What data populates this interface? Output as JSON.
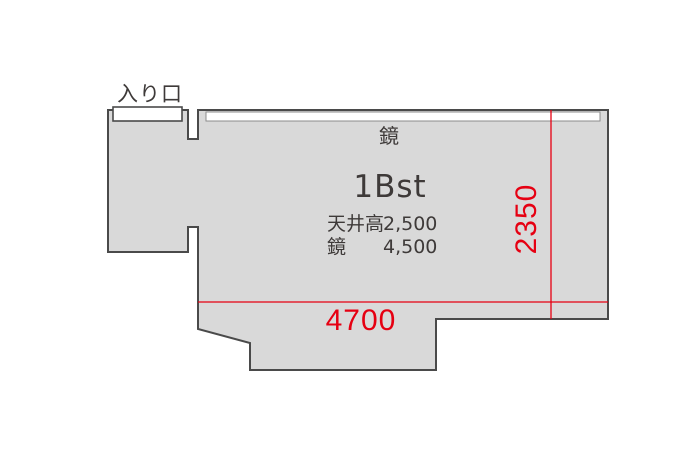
{
  "plan": {
    "entrance_label": "入り口",
    "mirror_label": "鏡",
    "room_name": "1Bst",
    "specs": {
      "rows": [
        {
          "label": "天井高",
          "value": "2,500"
        },
        {
          "label": "鏡",
          "value": "4,500"
        }
      ]
    },
    "dimensions": {
      "width_mm": "4700",
      "height_mm": "2350"
    }
  },
  "colors": {
    "floor_fill": "#d9d9d9",
    "outline": "#4a4a4a",
    "dimension_red": "#e60012",
    "text_dark": "#3e3a39",
    "background": "#ffffff"
  }
}
